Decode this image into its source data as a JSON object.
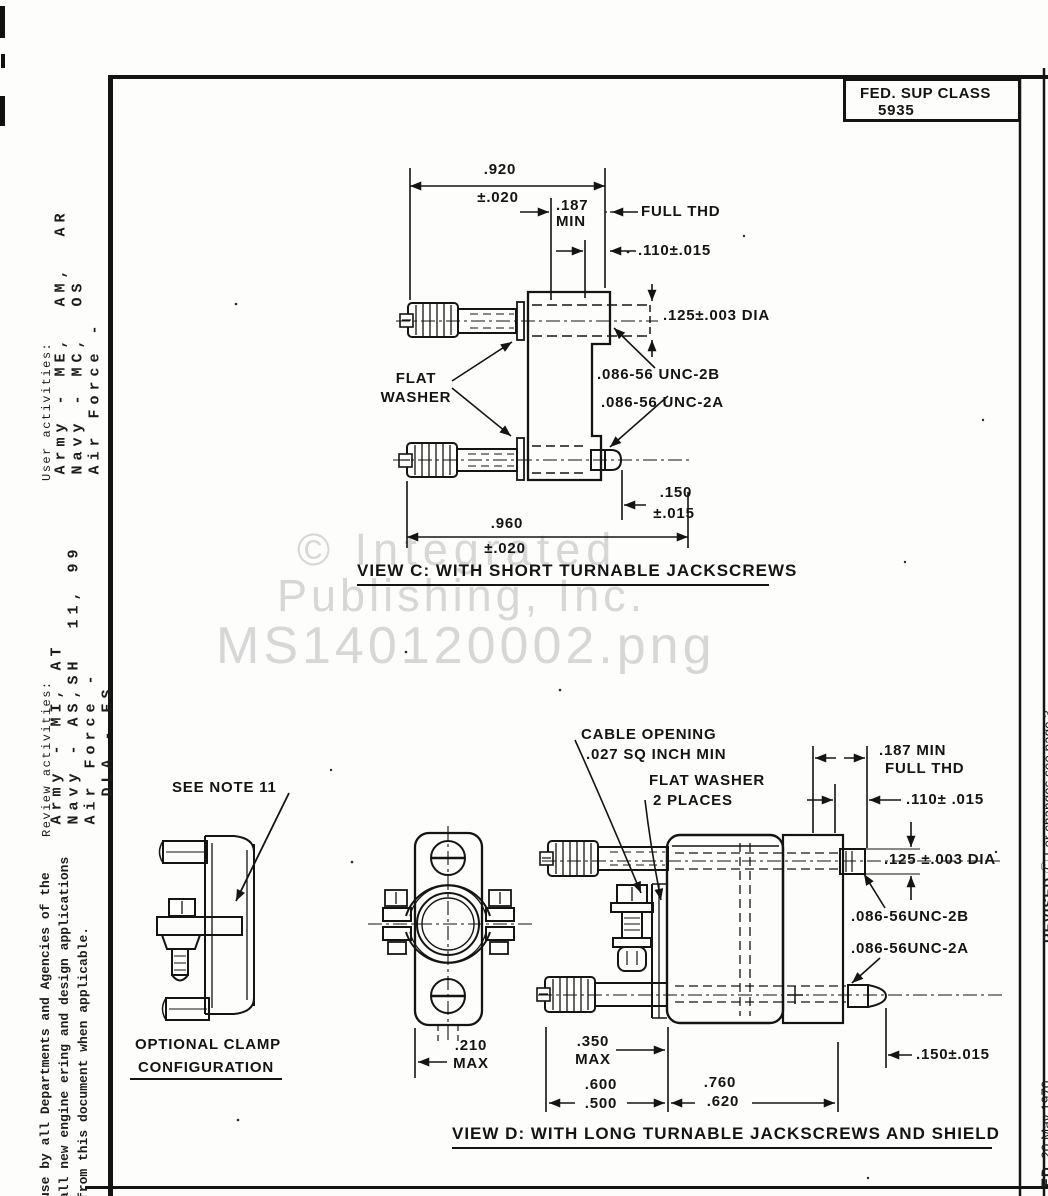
{
  "page": {
    "fed_sup_class_label": "FED. SUP CLASS",
    "fed_sup_class_value": "5935"
  },
  "watermark": {
    "line1": "© Integrated",
    "line2": "Publishing, Inc.",
    "line3": "MS140120002.png"
  },
  "margins": {
    "user_activities_label": "User activities:",
    "user_activities_lines": "Army - ME,  AM,  AR\nNavy - MC,  OS\nAir Force -",
    "review_activities_label": "Review activities:",
    "review_activities_lines": "Army - MI, AT\nNavy - AS,SH  11, 99\nAir Force -\n  DLA - ES",
    "usage_note": "use by all Departments and Agencies of the\nall new engine ering and design applications\nfrom this document when applicable.",
    "revised_bold": "REVISED",
    "revised_rest": " Ⓒ For changes see page 3",
    "date_bold": "ED",
    "date_rest": "  20 May 1970"
  },
  "view_c": {
    "dim_920": ".920",
    "tol_920": "±.020",
    "dim_187": ".187",
    "dim_187_min": "MIN",
    "full_thd": "FULL THD",
    "dim_110": ".110±.015",
    "dim_125": ".125±.003 DIA",
    "flat_washer_1": "FLAT",
    "flat_washer_2": "WASHER",
    "thread_b": ".086-56 UNC-2B",
    "thread_a": ".086-56 UNC-2A",
    "dim_150": ".150",
    "tol_150": "±.015",
    "dim_960": ".960",
    "tol_960": "±.020",
    "caption": "VIEW C: WITH SHORT TURNABLE JACKSCREWS"
  },
  "view_d": {
    "cable_1": "CABLE OPENING",
    "cable_2": ".027 SQ INCH MIN",
    "washer_1": "FLAT WASHER",
    "washer_2": "2 PLACES",
    "dim_187_1": ".187 MIN",
    "dim_187_2": "FULL THD",
    "dim_110": ".110± .015",
    "dim_125": ".125 ±.003 DIA",
    "thread_b": ".086-56UNC-2B",
    "thread_a": ".086-56UNC-2A",
    "dim_150": ".150±.015",
    "see_note": "SEE NOTE 11",
    "clamp_1": "OPTIONAL CLAMP",
    "clamp_2": "CONFIGURATION",
    "dim_210": ".210",
    "dim_210_max": "MAX",
    "dim_350": ".350",
    "dim_350_max": "MAX",
    "dim_600_hi": ".600",
    "dim_600_lo": ".500",
    "dim_760_hi": ".760",
    "dim_760_lo": ".620",
    "caption": "VIEW D: WITH LONG TURNABLE JACKSCREWS AND SHIELD"
  }
}
